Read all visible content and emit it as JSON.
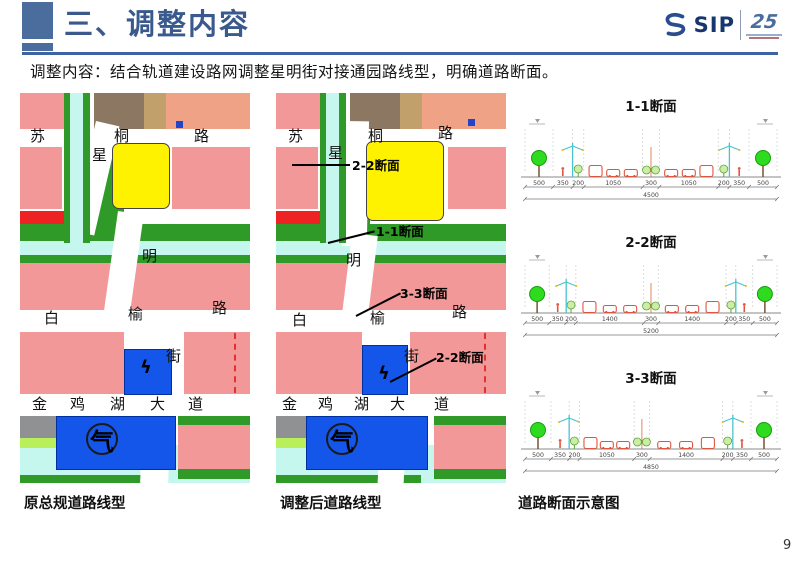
{
  "header": {
    "title": "三、调整内容",
    "logo_text": "SIP",
    "logo_anniversary": "25"
  },
  "subtitle": "调整内容：结合轨道建设路网调整星明街对接通园路线型，明确道路断面。",
  "map_labels": {
    "sutonglu": "苏桐路",
    "xingmingjie": "星明街",
    "baiyulu": "白榆路",
    "jinjihudadao": "金鸡湖大道",
    "gas": "气",
    "power": "ϟ"
  },
  "maps": {
    "left_caption": "原总规道路线型",
    "middle_caption": "调整后道路线型",
    "middle_callouts": [
      "2-2断面",
      "1-1断面",
      "3-3断面",
      "2-2断面"
    ]
  },
  "sections_caption": "道路断面示意图",
  "page_number": "9",
  "colors": {
    "accent_blue": "#4a6d9e",
    "title_blue": "#3a5a8e",
    "map_pink": "#f29898",
    "map_yellow": "#fef200",
    "map_green": "#2f9a27",
    "map_cyan": "#c6f7ee",
    "map_blue": "#1456ea",
    "map_red": "#ee2222"
  },
  "chart_data": [
    {
      "type": "cross-section",
      "title": "1-1断面",
      "dims_cm": [
        500,
        350,
        200,
        1050,
        300,
        1050,
        200,
        350,
        500
      ],
      "total": 4500
    },
    {
      "type": "cross-section",
      "title": "2-2断面",
      "dims_cm": [
        500,
        350,
        200,
        1400,
        300,
        1400,
        200,
        350,
        500
      ],
      "total": 5200
    },
    {
      "type": "cross-section",
      "title": "3-3断面",
      "dims_cm": [
        500,
        350,
        200,
        1050,
        300,
        1400,
        200,
        350,
        500
      ],
      "total": 4850
    }
  ]
}
